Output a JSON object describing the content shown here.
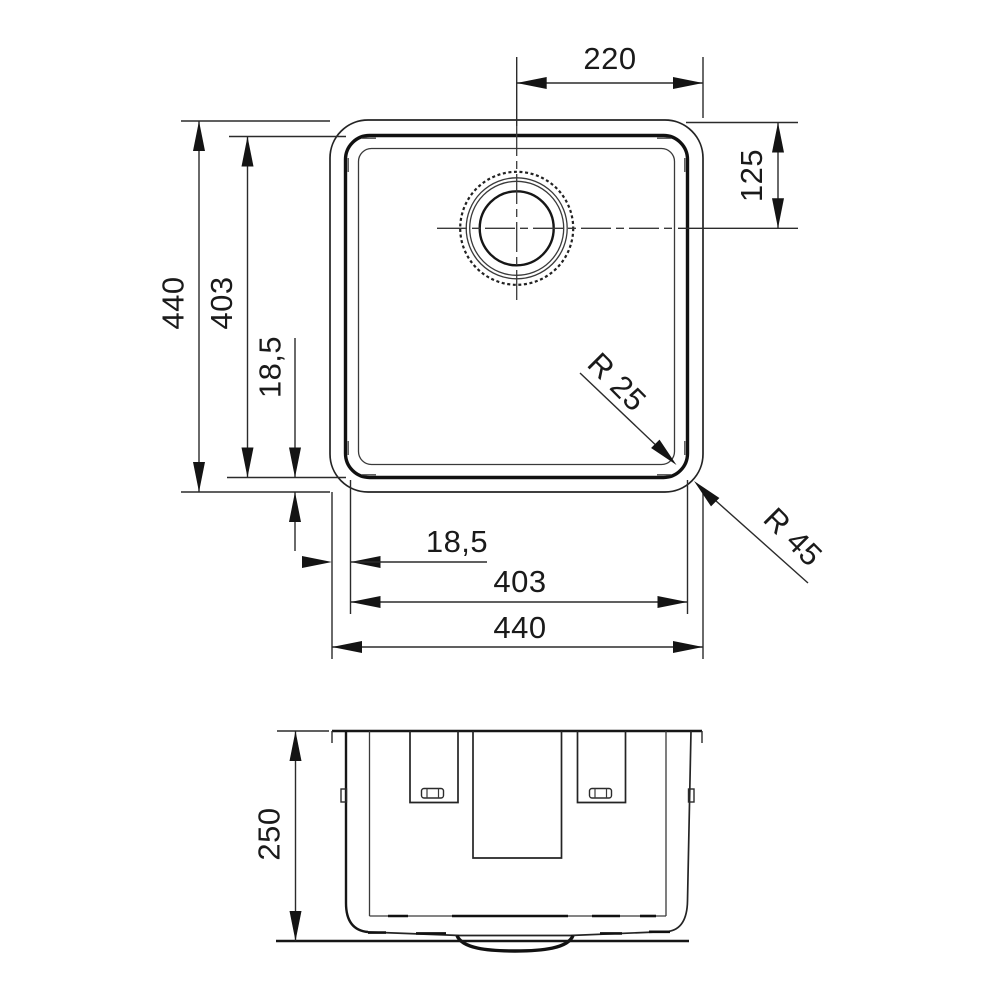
{
  "drawing": {
    "kind": "technical dimension drawing",
    "subject": "square undermount sink bowl, plan view and section view",
    "units": "mm",
    "line_color": "#1f1f1f",
    "background": "#ffffff"
  },
  "plan": {
    "dim_drain_to_right": "220",
    "dim_top_to_drain": "125",
    "dim_outer_height": "440",
    "dim_inner_height": "403",
    "dim_rim_offset_left": "18,5",
    "dim_rim_offset_bottom": "18,5",
    "dim_inner_width": "403",
    "dim_outer_width": "440",
    "radius_inner": "R 25",
    "radius_outer": "R 45"
  },
  "section": {
    "dim_depth": "250"
  }
}
